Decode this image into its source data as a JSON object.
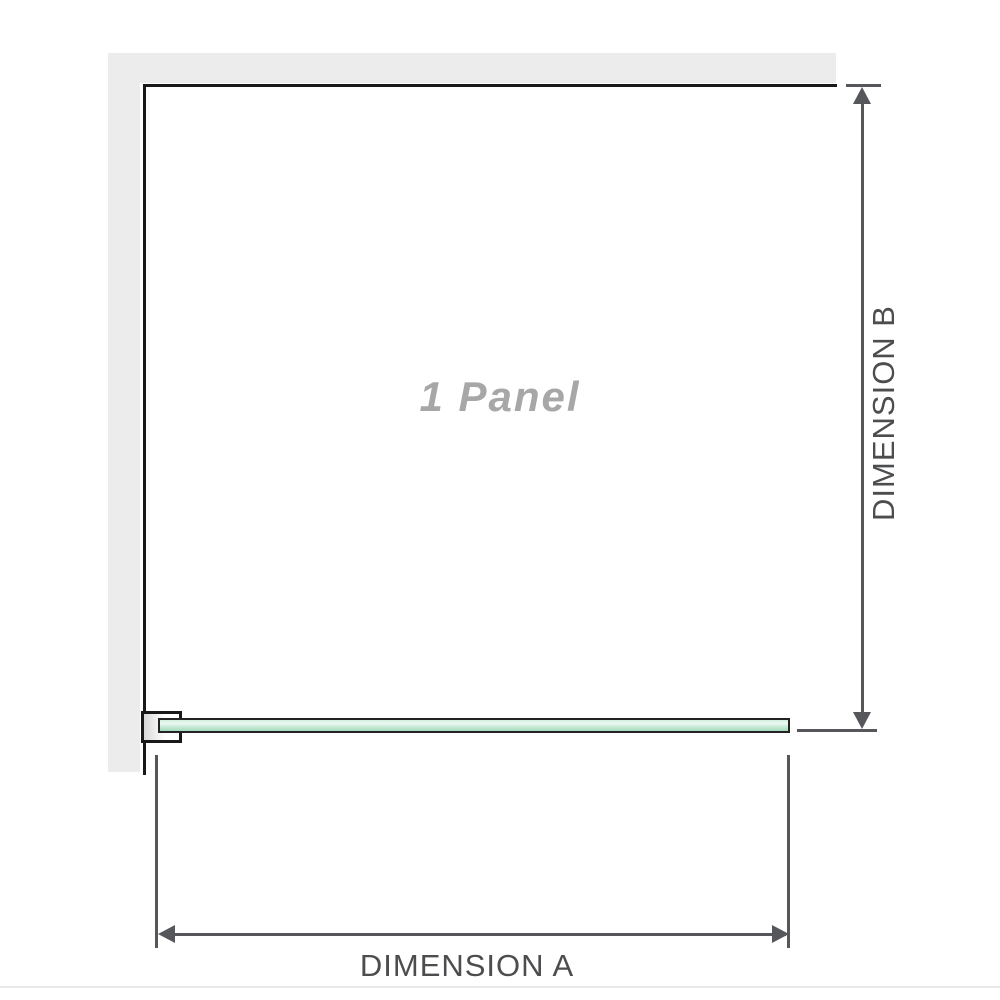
{
  "diagram": {
    "panel_label": "1 Panel",
    "dimension_a": {
      "label": "DIMENSION A"
    },
    "dimension_b": {
      "label": "DIMENSION B"
    }
  },
  "colors": {
    "background": "#ffffff",
    "wall_fill": "#ececec",
    "structure_line": "#191919",
    "glass_border": "#232323",
    "glass_green": "#a5dabb",
    "glass_green_highlight": "#eef9f3",
    "dimension_line": "#56575a",
    "dimension_label": "#4c4d4f",
    "panel_label_gray": "#a7a7a7",
    "bottom_separator": "#e8e8e8"
  }
}
